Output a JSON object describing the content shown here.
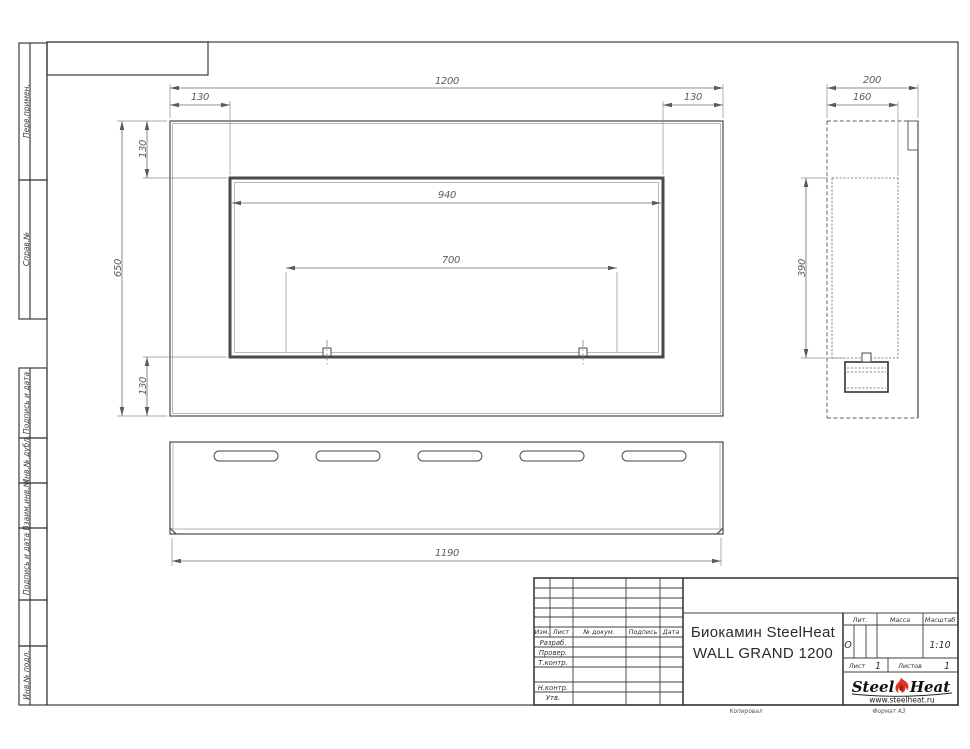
{
  "sheet": {
    "margin_labels": [
      "Перв.примен.",
      "Справ.№",
      "Подпись и дата",
      "Инв.№ дубл.",
      "Взаим.инв.№",
      "Подпись и дата",
      "Инв.№ подл."
    ],
    "line_color": "#4c4c4c"
  },
  "views": {
    "front": {
      "dim_width": "1200",
      "dim_left_offset": "130",
      "dim_right_offset": "130",
      "dim_top_offset": "130",
      "dim_height": "650",
      "dim_bottom_offset": "130",
      "dim_opening_width": "940",
      "dim_burner_span": "700"
    },
    "side": {
      "dim_depth": "200",
      "dim_inner_depth": "160",
      "dim_opening_height": "390"
    },
    "bottom": {
      "dim_length": "1190"
    }
  },
  "title_block": {
    "cols": {
      "izm": "Изм.",
      "list": "Лист",
      "doc": "№ докум.",
      "sign": "Подпись",
      "date": "Дата"
    },
    "rows": {
      "razrab": "Разраб.",
      "prover": "Провер.",
      "tkontr": "Т.контр.",
      "nkontr": "Н.контр.",
      "utv": "Утв."
    },
    "title_line1": "Биокамин SteelHeat",
    "title_line2": "WALL GRAND 1200",
    "lit_label": "Лит.",
    "lit_value": "О",
    "massa_label": "Масса",
    "scale_label": "Масштаб",
    "scale_value": "1:10",
    "sheet_label": "Лист",
    "sheet_value": "1",
    "sheets_label": "Листов",
    "sheets_value": "1",
    "logo": {
      "part1": "Steel",
      "part2": "Heat",
      "url": "www.steelheat.ru",
      "flame_color": "#e03222"
    },
    "footer": {
      "copied": "Копировал",
      "format": "Формат А3"
    }
  }
}
